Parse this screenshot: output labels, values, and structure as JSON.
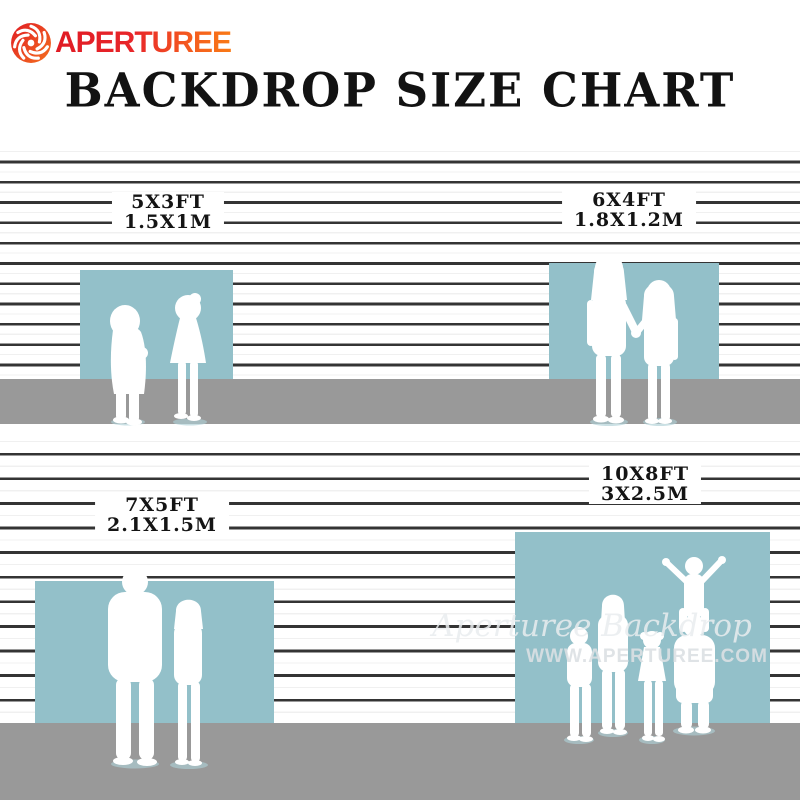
{
  "brand": {
    "name": "APERTUREE",
    "icon": "aperture-icon",
    "gradient_start": "#e01b24",
    "gradient_end": "#f97a16"
  },
  "title": "BACKDROP SIZE CHART",
  "sizes": [
    {
      "id": "5x3",
      "ft": "5X3FT",
      "m": "1.5X1M"
    },
    {
      "id": "6x4",
      "ft": "6X4FT",
      "m": "1.8X1.2M"
    },
    {
      "id": "7x5",
      "ft": "7X5FT",
      "m": "2.1X1.5M"
    },
    {
      "id": "10x8",
      "ft": "10X8FT",
      "m": "3X2.5M"
    }
  ],
  "scenes": [
    {
      "size": "5x3ft",
      "figures": "two toddlers facing each other"
    },
    {
      "size": "6x4ft",
      "figures": "two girls holding hands"
    },
    {
      "size": "7x5ft",
      "figures": "man and woman standing together"
    },
    {
      "size": "10x8ft",
      "figures": "family of five, child on father's shoulders"
    }
  ],
  "watermark": {
    "script": "Aperturee Backdrop",
    "url": "WWW.APERTUREE.COM"
  },
  "colors": {
    "backdrop_blue": "#93c0c9",
    "floor_gray": "#999999",
    "wall_line": "#343434",
    "text_black": "#141414"
  }
}
